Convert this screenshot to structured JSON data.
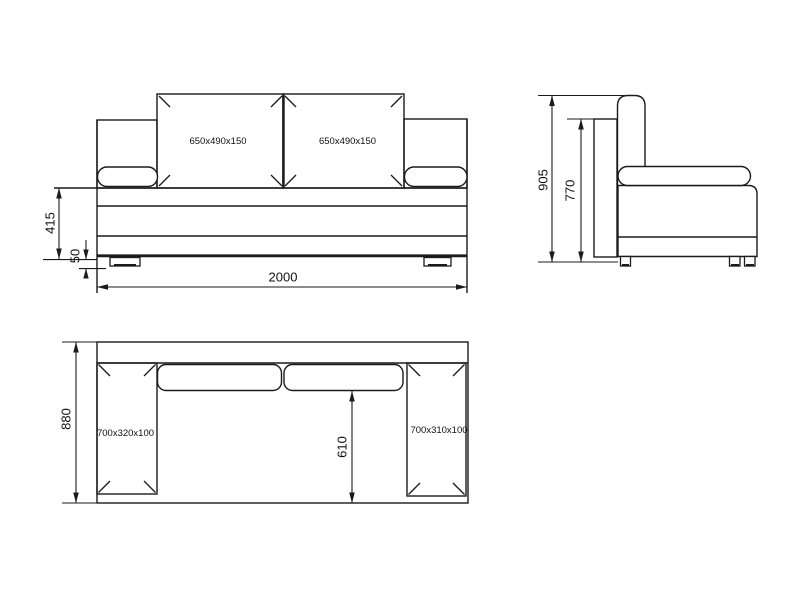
{
  "drawing": {
    "kind": "sofa-three-view-dimension-drawing",
    "colors": {
      "line": "#1b1b1b",
      "background": "#ffffff"
    },
    "front_view": {
      "left_cushion_label": "650x490x150",
      "right_cushion_label": "650x490x150",
      "seat_height_dim": "415",
      "foot_height_dim": "50",
      "overall_width_dim": "2000"
    },
    "side_view": {
      "overall_height_dim": "905",
      "backrest_height_dim": "770"
    },
    "top_view": {
      "left_armrest_label": "700x320x100",
      "right_armrest_label": "700x310x100",
      "overall_depth_dim": "880",
      "seat_depth_dim": "610"
    }
  }
}
